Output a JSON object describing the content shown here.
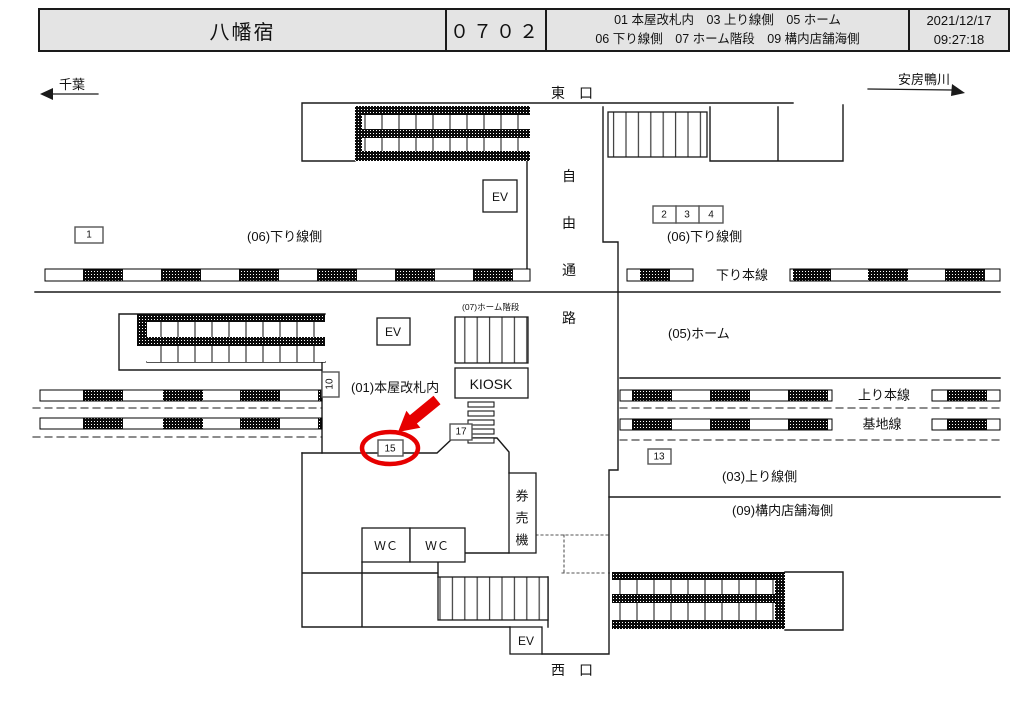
{
  "header": {
    "station_name": "八幡宿",
    "train_code": "０７０２",
    "categories_line1": "01 本屋改札内　03 上り線側　05 ホーム",
    "categories_line2": "06 下り線側　07 ホーム階段　09 構内店舗海側",
    "date": "2021/12/17",
    "time": "09:27:18"
  },
  "directions": {
    "left_label": "千葉",
    "right_label": "安房鴨川"
  },
  "map": {
    "east_exit": "東　口",
    "west_exit": "西　口",
    "passage_chars": [
      "自",
      "由",
      "通",
      "路"
    ],
    "ticket_machine_chars": [
      "券",
      "売",
      "機"
    ],
    "labels": {
      "down_side_left": "(06)下り線側",
      "down_side_right": "(06)下り線側",
      "down_main_line": "下り本線",
      "platform": "(05)ホーム",
      "platform_stairs": "(07)ホーム階段",
      "main_gate": "(01)本屋改札内",
      "up_main_line": "上り本線",
      "base_line": "基地線",
      "up_side": "(03)上り線側",
      "shop_sea_side": "(09)構内店舗海側",
      "kiosk": "KIOSK",
      "ev": "EV",
      "wc": "ＷＣ"
    },
    "positions": {
      "no1": "1",
      "no2": "2",
      "no3": "3",
      "no4": "4",
      "no10": "10",
      "no13": "13",
      "no15": "15",
      "no17": "17"
    },
    "highlighted_position": "15",
    "highlight_color": "#e60000"
  }
}
